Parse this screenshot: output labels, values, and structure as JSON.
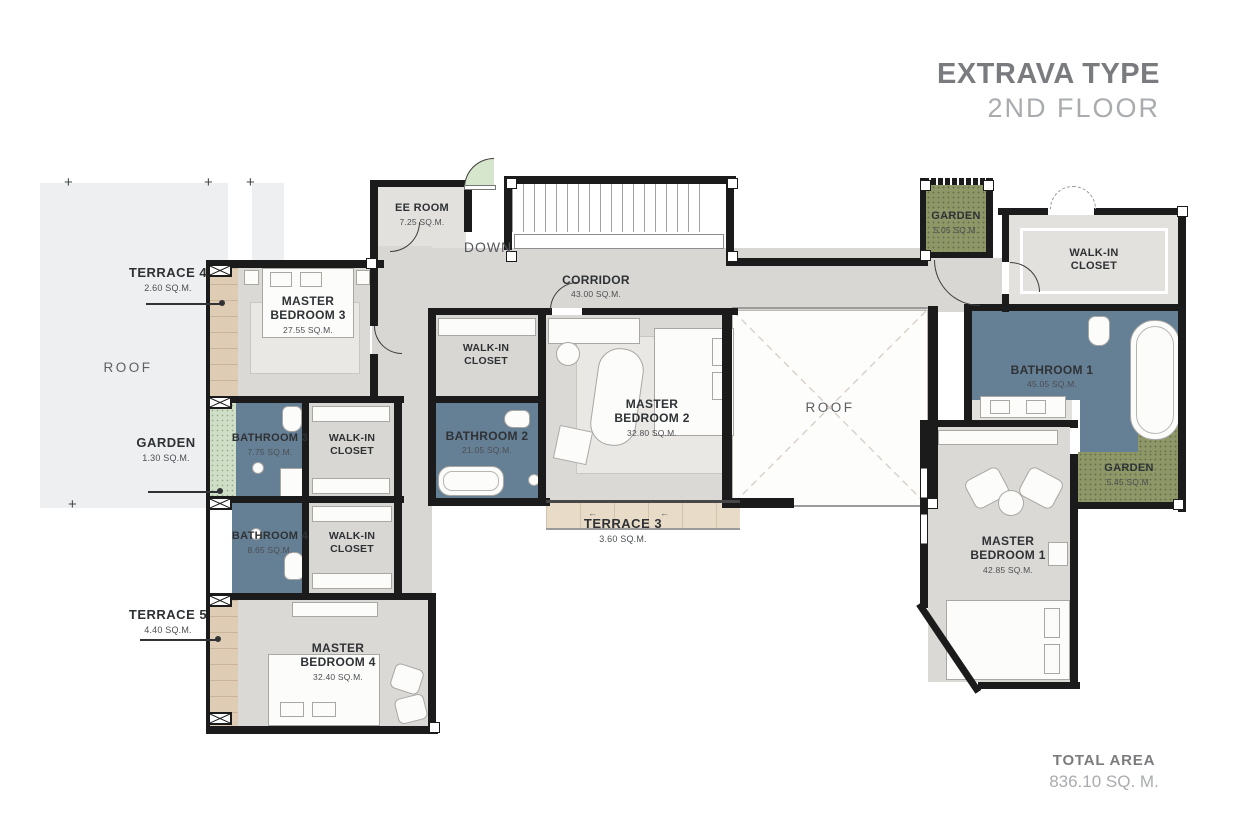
{
  "header": {
    "title": "EXTRAVA TYPE",
    "subtitle": "2ND FLOOR"
  },
  "footer": {
    "label": "TOTAL AREA",
    "value": "836.10 SQ. M."
  },
  "colors": {
    "wall": "#1b1b1b",
    "floor": "#d9d7d3",
    "floor_light": "#e3e1dd",
    "bathroom": "#657f95",
    "garden": "#8d9768",
    "garden_light": "#cfdec6",
    "wood": "#dfccb5",
    "wood_light": "#e8dcc8",
    "roof": "#edeff1",
    "rug": "#eae8e4",
    "title": "#797b7e",
    "subtitle": "#a9abae",
    "label": "#2f3235",
    "area_label": "#4c4f53"
  },
  "plan": {
    "roof_left": {
      "name": "ROOF"
    },
    "roof_center": {
      "name": "ROOF"
    },
    "terrace_4": {
      "name": "TERRACE 4",
      "area": "2.60 SQ.M."
    },
    "garden_1": {
      "name": "GARDEN",
      "area": "1.30 SQ.M."
    },
    "terrace_5": {
      "name": "TERRACE 5",
      "area": "4.40 SQ.M."
    },
    "master_bedroom_3": {
      "name": "MASTER BEDROOM 3",
      "area": "27.55 SQ.M."
    },
    "bathroom_3": {
      "name": "BATHROOM 3",
      "area": "7.75 SQ.M."
    },
    "walk_in_closet_1": {
      "name": "WALK-IN CLOSET"
    },
    "bathroom_4": {
      "name": "BATHROOM 4",
      "area": "8.65 SQ.M."
    },
    "walk_in_closet_2": {
      "name": "WALK-IN CLOSET"
    },
    "master_bedroom_4": {
      "name": "MASTER BEDROOM 4",
      "area": "32.40 SQ.M."
    },
    "ee_room": {
      "name": "EE ROOM",
      "area": "7.25 SQ.M."
    },
    "down": {
      "name": "DOWN"
    },
    "corridor": {
      "name": "CORRIDOR",
      "area": "43.00 SQ.M."
    },
    "walk_in_closet_center": {
      "name": "WALK-IN CLOSET"
    },
    "bathroom_2": {
      "name": "BATHROOM 2",
      "area": "21.05 SQ.M."
    },
    "master_bedroom_2": {
      "name": "MASTER BEDROOM 2",
      "area": "32.80 SQ.M."
    },
    "terrace_3": {
      "name": "TERRACE 3",
      "area": "3.60 SQ.M."
    },
    "garden_2": {
      "name": "GARDEN",
      "area": "5.05 SQ.M."
    },
    "walk_in_closet_right": {
      "name": "WALK-IN CLOSET"
    },
    "bathroom_1": {
      "name": "BATHROOM 1",
      "area": "45.05 SQ.M."
    },
    "garden_3": {
      "name": "GARDEN",
      "area": "5.45 SQ.M."
    },
    "master_bedroom_1": {
      "name": "MASTER BEDROOM 1",
      "area": "42.85 SQ.M."
    }
  },
  "markers": {
    "slide_arrow": "←",
    "plus": "+"
  }
}
